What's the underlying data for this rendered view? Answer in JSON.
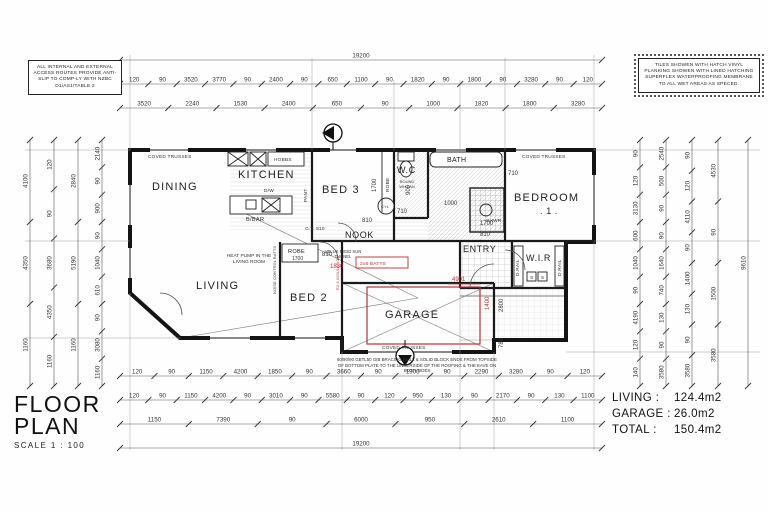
{
  "sheet": {
    "title": "FLOOR PLAN",
    "scale": "SCALE 1 : 100",
    "areas": {
      "living_label": "LIVING :",
      "living_value": "124.4m2",
      "garage_label": "GARAGE :",
      "garage_value": "26.0m2",
      "total_label": "TOTAL :",
      "total_value": "150.4m2"
    }
  },
  "notes": {
    "access": "ALL INTERNAL AND EXTERNAL ACCESS ROUTES PROVIDE ANTI-SLIP TO COMP-LY WITH NZBC D1/AS1/TABLE 2",
    "tiles": "TILES SHOWEN WITH HATCH VINYL PLANKING SHOWEN WITH LINED HATCHING SUPERFLEX WATERPROOFING MEMBRANE TO ALL WET AREAS AS SPECED."
  },
  "rooms": {
    "dining": "DINING",
    "kitchen": "KITCHEN",
    "bed3": "BED 3",
    "wc": "W.C",
    "bath": "BATH",
    "bedroom1": "BEDROOM",
    "bedroom1_number": ". 1 .",
    "living": "LIVING",
    "bed2": "BED 2",
    "nook": "NOOK",
    "entry": "ENTRY",
    "wir": "W.I.R",
    "garage": "GARAGE"
  },
  "annotations": {
    "coved_trusses": "COVED TRUSSES",
    "hobbs": "HOBBS",
    "dw": "D/W",
    "bbar": "B/BAR",
    "pant": "PANT",
    "robe": "ROBE",
    "cyl": "CYL",
    "shwr": "SHWR",
    "drail": "D.RAIL",
    "shelf": "S",
    "heat_pump": "HEAT PUMP IN THE LIVING ROOM",
    "velux": "VELUX RIGID SUN TUNNEL",
    "wh_fan": "ROUND WH FAN",
    "noise_batts": "NOISE CONTROL BATTS",
    "insulation": "R2.6 INSULATION",
    "batts": "2x6 BATTS",
    "garage_note": "50/90/90 GBTL50 GIB BRACING WALL & SOLID BLOCK ENDS FROM TOPSIDE OF BOTTOM PLATE TO THE UNDERSIDE OF THE ROOFING & THE EAVE ON BOTH SIDES"
  },
  "inline_dims": {
    "d810": "810",
    "d710": "710",
    "d1700": "1700",
    "d1830": "1830",
    "d2800": "2800",
    "d780": "780",
    "d4901": "4901",
    "d900": "900",
    "d1000": "1000",
    "d1400": "1400",
    "gt": "G.T. 810"
  },
  "dimensions": {
    "top": {
      "overall": "19200",
      "row2": [
        "120",
        "90",
        "3520",
        "3770",
        "90",
        "2400",
        "90",
        "650",
        "1100",
        "90",
        "1820",
        "90",
        "1800",
        "90",
        "3280",
        "90",
        "120"
      ],
      "row3": [
        "3520",
        "2240",
        "1530",
        "2400",
        "650",
        "90",
        "1000",
        "1820",
        "1800",
        "3280"
      ]
    },
    "bottom": {
      "row1": [
        "120",
        "90",
        "1150",
        "4200",
        "1850",
        "90",
        "3660",
        "90",
        "1900",
        "90",
        "2290",
        "3280",
        "90",
        "120"
      ],
      "row2": [
        "120",
        "90",
        "1150",
        "4200",
        "90",
        "3010",
        "90",
        "5580",
        "90",
        "120",
        "950",
        "130",
        "90",
        "2170",
        "90",
        "130",
        "1100"
      ],
      "row3": [
        "1150",
        "7390",
        "90",
        "6000",
        "950",
        "2610",
        "1100"
      ],
      "overall": "19200"
    },
    "left": {
      "col1": [
        "4100",
        "4350",
        "1160"
      ],
      "col2": [
        "120",
        "90",
        "3680",
        "4350",
        "1160"
      ],
      "col3": [
        "2840",
        "5190",
        "1160"
      ],
      "col4": [
        "2140",
        "90",
        "900",
        "90",
        "1040",
        "610",
        "90",
        "3080",
        "1160"
      ]
    },
    "right": {
      "col1": [
        "90",
        "120",
        "3130",
        "600",
        "1040",
        "90",
        "4190",
        "120",
        "140"
      ],
      "col2": [
        "2540",
        "500",
        "90",
        "90",
        "1640",
        "740",
        "130",
        "90",
        "3580"
      ],
      "col3": [
        "90",
        "120",
        "4110",
        "90",
        "1400",
        "130",
        "90",
        "3580"
      ],
      "col4": [
        "4530",
        "90",
        "1500",
        "3580"
      ],
      "overall": "9610"
    }
  }
}
